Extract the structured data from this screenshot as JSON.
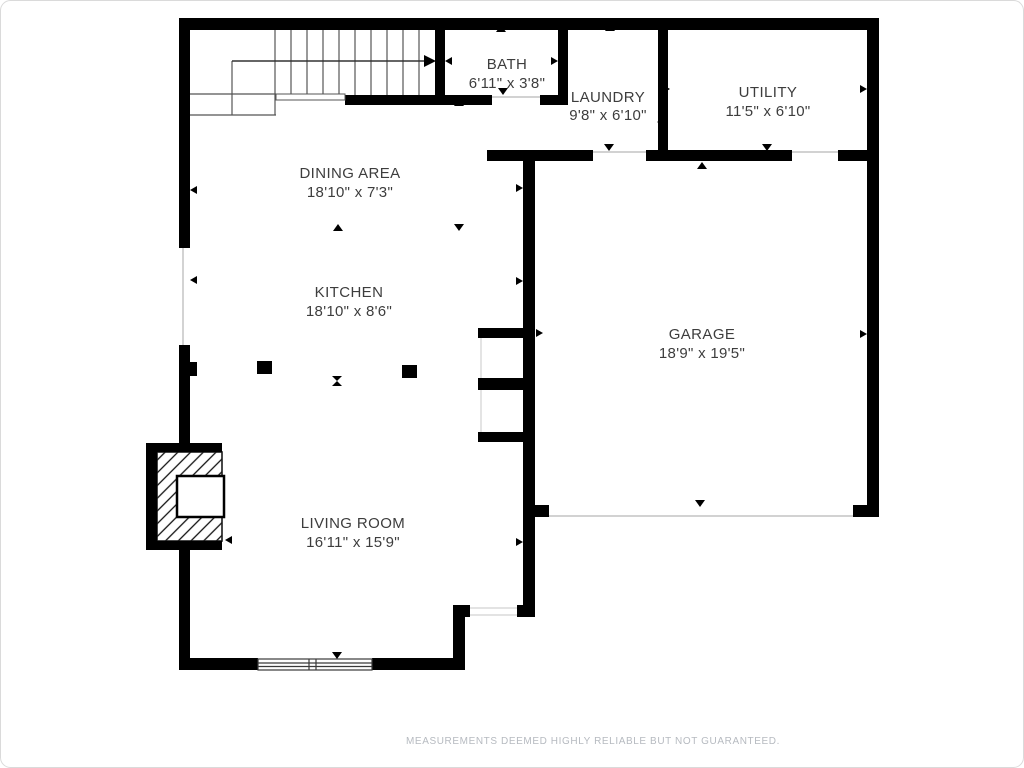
{
  "canvas": {
    "width": 1024,
    "height": 768,
    "background": "#ffffff",
    "border_color": "#dadada"
  },
  "colors": {
    "wall": "#000000",
    "room_text": "#3d3d3d",
    "thin_line": "#c4c4c4",
    "stair_line": "#555555",
    "disclaimer": "#b6bac0"
  },
  "rooms": [
    {
      "id": "bath",
      "name": "BATH",
      "dims": "6'11\" x 3'8\""
    },
    {
      "id": "laundry",
      "name": "LAUNDRY",
      "dims": "9'8\" x 6'10\""
    },
    {
      "id": "utility",
      "name": "UTILITY",
      "dims": "11'5\" x 6'10\""
    },
    {
      "id": "dining",
      "name": "DINING AREA",
      "dims": "18'10\" x 7'3\""
    },
    {
      "id": "kitchen",
      "name": "KITCHEN",
      "dims": "18'10\" x 8'6\""
    },
    {
      "id": "garage",
      "name": "GARAGE",
      "dims": "18'9\" x 19'5\""
    },
    {
      "id": "living",
      "name": "LIVING ROOM",
      "dims": "16'11\" x 15'9\""
    }
  ],
  "footer": {
    "disclaimer": "MEASUREMENTS DEEMED HIGHLY RELIABLE BUT NOT GUARANTEED."
  }
}
